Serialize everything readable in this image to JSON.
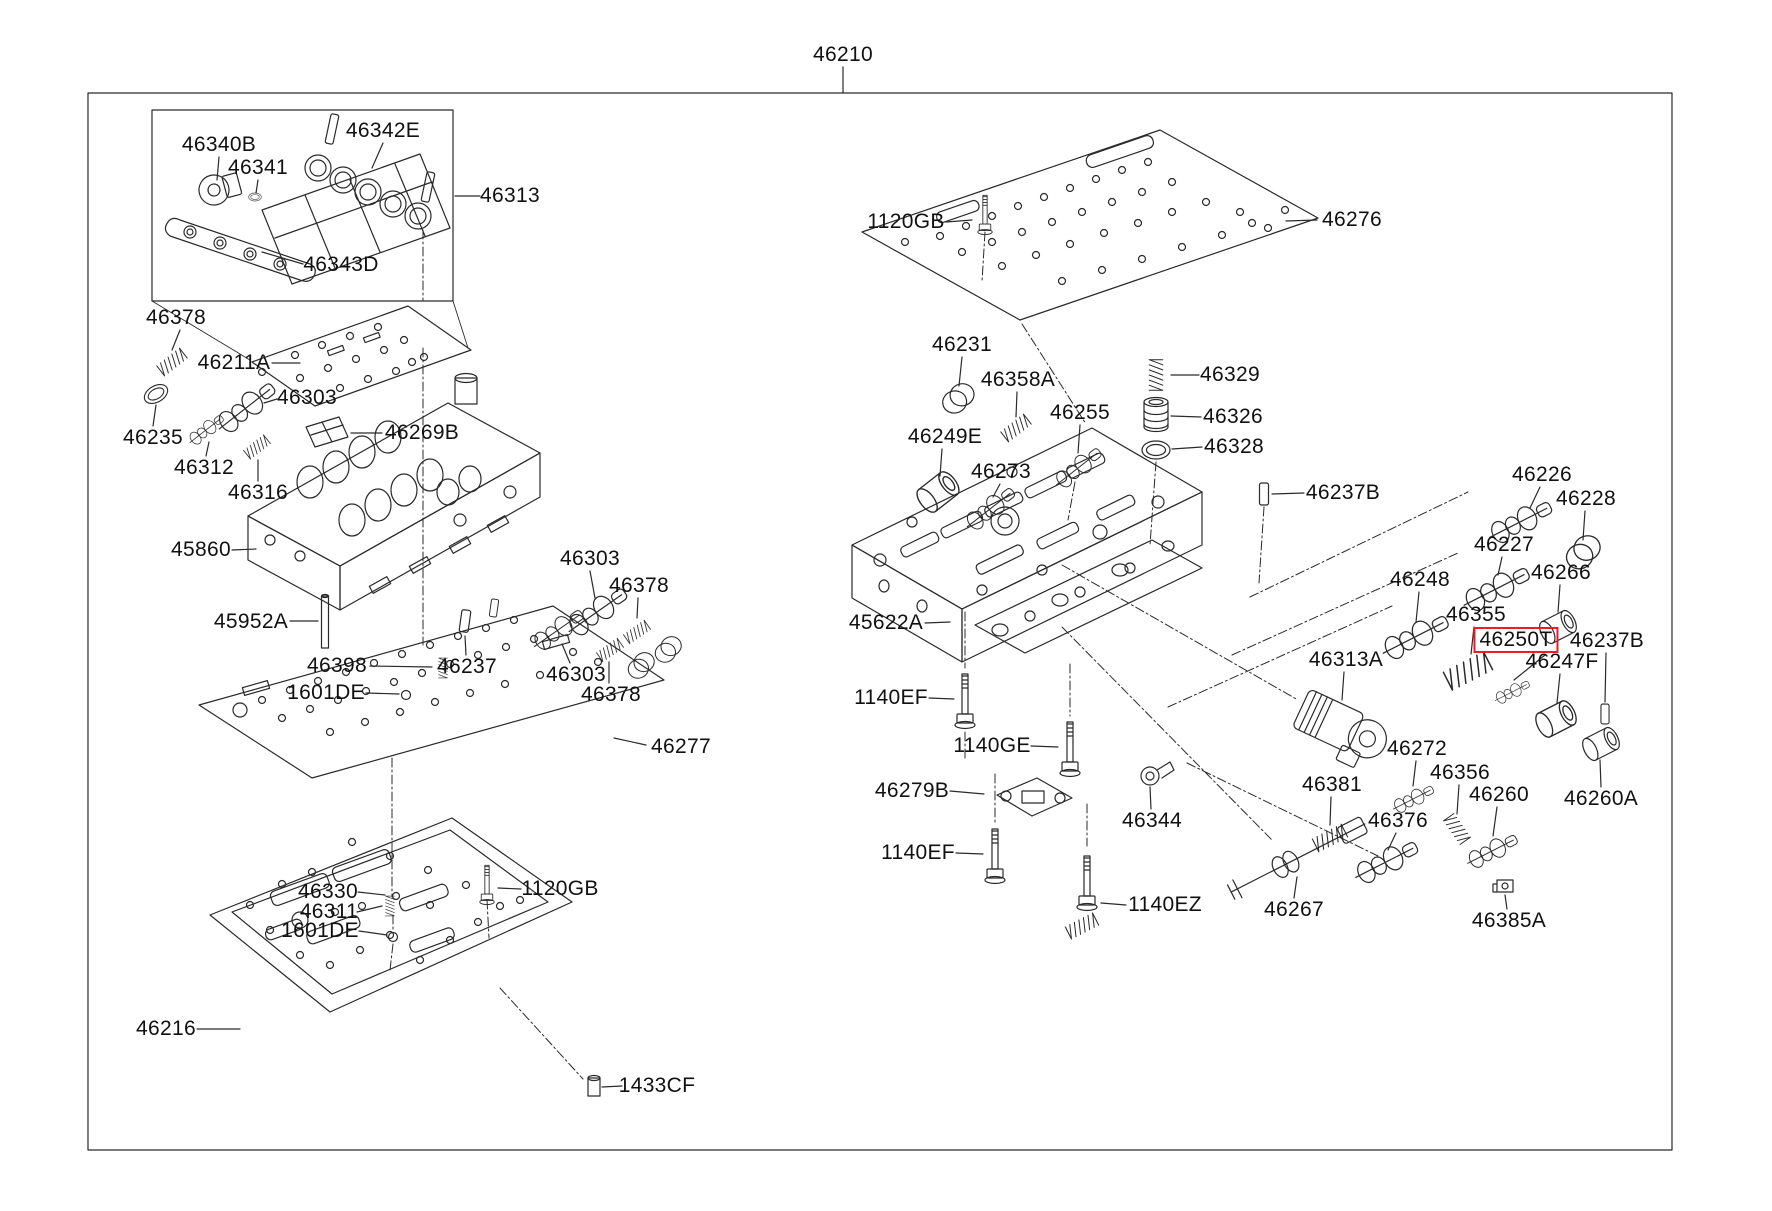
{
  "diagram": {
    "assembly_label": "46210",
    "highlight_color": "#ed1c24",
    "line_color": "#2a2a2a",
    "background": "#ffffff",
    "labels": [
      {
        "id": "46210",
        "t": "46210",
        "x": 843,
        "y": 55,
        "l": [
          843,
          67,
          843,
          93
        ]
      },
      {
        "id": "46340B",
        "t": "46340B",
        "x": 219,
        "y": 145,
        "l": [
          219,
          157,
          217,
          180
        ]
      },
      {
        "id": "46341",
        "t": "46341",
        "x": 258,
        "y": 168,
        "l": [
          258,
          180,
          256,
          193
        ]
      },
      {
        "id": "46342E",
        "t": "46342E",
        "x": 383,
        "y": 131,
        "l": [
          383,
          143,
          372,
          168
        ]
      },
      {
        "id": "46313",
        "t": "46313",
        "x": 510,
        "y": 196,
        "l": [
          480,
          196,
          455,
          196
        ]
      },
      {
        "id": "46343D",
        "t": "46343D",
        "x": 341,
        "y": 265,
        "l": [
          303,
          264,
          262,
          252
        ]
      },
      {
        "id": "46378a",
        "t": "46378",
        "x": 176,
        "y": 318,
        "l": [
          180,
          330,
          172,
          350
        ]
      },
      {
        "id": "46211A",
        "t": "46211A",
        "x": 234,
        "y": 363,
        "l": [
          272,
          363,
          300,
          363
        ]
      },
      {
        "id": "46303a",
        "t": "46303",
        "x": 307,
        "y": 398,
        "l": [
          277,
          399,
          264,
          403
        ]
      },
      {
        "id": "46235",
        "t": "46235",
        "x": 153,
        "y": 438,
        "l": [
          153,
          426,
          156,
          405
        ]
      },
      {
        "id": "46269B",
        "t": "46269B",
        "x": 422,
        "y": 433,
        "l": [
          382,
          433,
          351,
          433
        ]
      },
      {
        "id": "46312",
        "t": "46312",
        "x": 204,
        "y": 468,
        "l": [
          206,
          456,
          209,
          442
        ]
      },
      {
        "id": "46316",
        "t": "46316",
        "x": 258,
        "y": 493,
        "l": [
          258,
          481,
          258,
          460
        ]
      },
      {
        "id": "45860",
        "t": "45860",
        "x": 201,
        "y": 550,
        "l": [
          232,
          550,
          256,
          549
        ]
      },
      {
        "id": "45952A",
        "t": "45952A",
        "x": 251,
        "y": 622,
        "l": [
          290,
          621,
          318,
          621
        ]
      },
      {
        "id": "46398",
        "t": "46398",
        "x": 337,
        "y": 666,
        "l": [
          370,
          666,
          432,
          667
        ]
      },
      {
        "id": "46237a",
        "t": "46237",
        "x": 467,
        "y": 667,
        "l": [
          466,
          655,
          465,
          636
        ]
      },
      {
        "id": "46303b",
        "t": "46303",
        "x": 590,
        "y": 559,
        "l": [
          590,
          571,
          595,
          598
        ]
      },
      {
        "id": "46378b",
        "t": "46378",
        "x": 639,
        "y": 586,
        "l": [
          638,
          598,
          637,
          618
        ]
      },
      {
        "id": "46303c",
        "t": "46303",
        "x": 576,
        "y": 675,
        "l": [
          570,
          663,
          562,
          644
        ]
      },
      {
        "id": "46378c",
        "t": "46378",
        "x": 611,
        "y": 695,
        "l": [
          609,
          683,
          609,
          662
        ]
      },
      {
        "id": "1601DEa",
        "t": "1601DE",
        "x": 326,
        "y": 693,
        "l": [
          366,
          693,
          399,
          694
        ]
      },
      {
        "id": "46277",
        "t": "46277",
        "x": 681,
        "y": 747,
        "l": [
          646,
          745,
          614,
          738
        ]
      },
      {
        "id": "46330",
        "t": "46330",
        "x": 328,
        "y": 892,
        "l": [
          358,
          892,
          385,
          895
        ]
      },
      {
        "id": "46311",
        "t": "46311",
        "x": 329,
        "y": 912,
        "l": [
          357,
          912,
          382,
          906
        ]
      },
      {
        "id": "1601DEb",
        "t": "1601DE",
        "x": 320,
        "y": 931,
        "l": [
          359,
          931,
          387,
          935
        ]
      },
      {
        "id": "1120GBa",
        "t": "1120GB",
        "x": 560,
        "y": 889,
        "l": [
          521,
          889,
          498,
          888
        ]
      },
      {
        "id": "46216",
        "t": "46216",
        "x": 166,
        "y": 1029,
        "l": [
          197,
          1029,
          240,
          1029
        ]
      },
      {
        "id": "1433CF",
        "t": "1433CF",
        "x": 657,
        "y": 1086,
        "l": [
          622,
          1086,
          602,
          1087
        ]
      },
      {
        "id": "1120GBb",
        "t": "1120GB",
        "x": 906,
        "y": 222,
        "l": [
          946,
          222,
          972,
          220
        ]
      },
      {
        "id": "46276",
        "t": "46276",
        "x": 1352,
        "y": 220,
        "l": [
          1317,
          220,
          1286,
          221
        ]
      },
      {
        "id": "46231",
        "t": "46231",
        "x": 962,
        "y": 345,
        "l": [
          962,
          357,
          959,
          386
        ]
      },
      {
        "id": "46358A",
        "t": "46358A",
        "x": 1018,
        "y": 380,
        "l": [
          1017,
          392,
          1016,
          417
        ]
      },
      {
        "id": "46255",
        "t": "46255",
        "x": 1080,
        "y": 413,
        "l": [
          1080,
          425,
          1078,
          453
        ]
      },
      {
        "id": "46249E",
        "t": "46249E",
        "x": 945,
        "y": 437,
        "l": [
          942,
          449,
          940,
          476
        ]
      },
      {
        "id": "46273",
        "t": "46273",
        "x": 1001,
        "y": 472,
        "l": [
          1000,
          484,
          993,
          497
        ]
      },
      {
        "id": "46329",
        "t": "46329",
        "x": 1230,
        "y": 375,
        "l": [
          1199,
          375,
          1171,
          375
        ]
      },
      {
        "id": "46326",
        "t": "46326",
        "x": 1233,
        "y": 417,
        "l": [
          1201,
          417,
          1171,
          416
        ]
      },
      {
        "id": "46328",
        "t": "46328",
        "x": 1234,
        "y": 447,
        "l": [
          1202,
          447,
          1172,
          449
        ]
      },
      {
        "id": "46237Ba",
        "t": "46237B",
        "x": 1343,
        "y": 493,
        "l": [
          1304,
          493,
          1272,
          494
        ]
      },
      {
        "id": "46226",
        "t": "46226",
        "x": 1542,
        "y": 475,
        "l": [
          1540,
          487,
          1530,
          508
        ]
      },
      {
        "id": "46228",
        "t": "46228",
        "x": 1586,
        "y": 499,
        "l": [
          1585,
          511,
          1583,
          540
        ]
      },
      {
        "id": "46227",
        "t": "46227",
        "x": 1504,
        "y": 545,
        "l": [
          1502,
          557,
          1498,
          575
        ]
      },
      {
        "id": "46248",
        "t": "46248",
        "x": 1420,
        "y": 580,
        "l": [
          1419,
          592,
          1416,
          622
        ]
      },
      {
        "id": "46266",
        "t": "46266",
        "x": 1561,
        "y": 573,
        "l": [
          1560,
          585,
          1558,
          612
        ]
      },
      {
        "id": "46355",
        "t": "46355",
        "x": 1476,
        "y": 615,
        "l": [
          1474,
          627,
          1471,
          654
        ]
      },
      {
        "id": "46250T",
        "t": "46250T",
        "x": 1516,
        "y": 640,
        "hl": true,
        "l": [
          1545,
          655,
          1514,
          680
        ]
      },
      {
        "id": "46237Bb",
        "t": "46237B",
        "x": 1607,
        "y": 641,
        "l": [
          1606,
          653,
          1605,
          702
        ]
      },
      {
        "id": "46247F",
        "t": "46247F",
        "x": 1562,
        "y": 662,
        "l": [
          1560,
          674,
          1557,
          703
        ]
      },
      {
        "id": "46313A",
        "t": "46313A",
        "x": 1346,
        "y": 660,
        "l": [
          1344,
          672,
          1342,
          700
        ]
      },
      {
        "id": "46272",
        "t": "46272",
        "x": 1417,
        "y": 749,
        "l": [
          1416,
          761,
          1413,
          786
        ]
      },
      {
        "id": "46356",
        "t": "46356",
        "x": 1460,
        "y": 773,
        "l": [
          1459,
          785,
          1457,
          814
        ]
      },
      {
        "id": "46260",
        "t": "46260",
        "x": 1499,
        "y": 795,
        "l": [
          1497,
          807,
          1493,
          836
        ]
      },
      {
        "id": "46260A",
        "t": "46260A",
        "x": 1601,
        "y": 799,
        "l": [
          1601,
          787,
          1600,
          760
        ]
      },
      {
        "id": "46381",
        "t": "46381",
        "x": 1332,
        "y": 785,
        "l": [
          1331,
          797,
          1330,
          825
        ]
      },
      {
        "id": "46376",
        "t": "46376",
        "x": 1398,
        "y": 821,
        "l": [
          1396,
          833,
          1388,
          850
        ]
      },
      {
        "id": "46385A",
        "t": "46385A",
        "x": 1509,
        "y": 921,
        "l": [
          1507,
          909,
          1505,
          895
        ]
      },
      {
        "id": "46344",
        "t": "46344",
        "x": 1152,
        "y": 821,
        "l": [
          1151,
          809,
          1150,
          787
        ]
      },
      {
        "id": "1140EZ",
        "t": "1140EZ",
        "x": 1165,
        "y": 905,
        "l": [
          1126,
          905,
          1101,
          903
        ]
      },
      {
        "id": "46267",
        "t": "46267",
        "x": 1294,
        "y": 910,
        "l": [
          1294,
          898,
          1297,
          877
        ]
      },
      {
        "id": "45622A",
        "t": "45622A",
        "x": 886,
        "y": 623,
        "l": [
          925,
          623,
          950,
          622
        ]
      },
      {
        "id": "1140EFa",
        "t": "1140EF",
        "x": 891,
        "y": 698,
        "l": [
          929,
          698,
          954,
          699
        ]
      },
      {
        "id": "1140GE",
        "t": "1140GE",
        "x": 992,
        "y": 746,
        "l": [
          1031,
          746,
          1058,
          747
        ]
      },
      {
        "id": "46279B",
        "t": "46279B",
        "x": 912,
        "y": 791,
        "l": [
          950,
          791,
          984,
          794
        ]
      },
      {
        "id": "1140EFb",
        "t": "1140EF",
        "x": 918,
        "y": 853,
        "l": [
          956,
          853,
          983,
          854
        ]
      }
    ],
    "parts": [
      {
        "g": "solenoid",
        "x": 214,
        "y": 190,
        "r": -15,
        "s": 1
      },
      {
        "g": "oring",
        "x": 255,
        "y": 197,
        "r": 0,
        "s": 0.45
      },
      {
        "g": "coil",
        "x": 172,
        "y": 362,
        "r": -38,
        "s": 0.8
      },
      {
        "g": "oring",
        "x": 156,
        "y": 394,
        "r": -30,
        "s": 0.9
      },
      {
        "g": "spool",
        "x": 246,
        "y": 408,
        "r": -38,
        "s": 1
      },
      {
        "g": "spool",
        "x": 206,
        "y": 430,
        "r": -38,
        "s": 0.6
      },
      {
        "g": "filter",
        "x": 327,
        "y": 433,
        "r": 0,
        "s": 1
      },
      {
        "g": "coil",
        "x": 257,
        "y": 447,
        "r": -38,
        "s": 0.7
      },
      {
        "g": "pin",
        "x": 325,
        "y": 622,
        "r": 0,
        "s": 1
      },
      {
        "g": "coil",
        "x": 443,
        "y": 668,
        "r": 90,
        "s": 0.55
      },
      {
        "g": "wedge",
        "x": 465,
        "y": 621,
        "r": 8,
        "s": 1
      },
      {
        "g": "wedge",
        "x": 494,
        "y": 608,
        "r": 8,
        "s": 0.8
      },
      {
        "g": "spool",
        "x": 597,
        "y": 612,
        "r": -35,
        "s": 1
      },
      {
        "g": "coil",
        "x": 637,
        "y": 632,
        "r": -35,
        "s": 0.7
      },
      {
        "g": "spool",
        "x": 558,
        "y": 630,
        "r": -35,
        "s": 0.85
      },
      {
        "g": "coil",
        "x": 610,
        "y": 650,
        "r": -35,
        "s": 0.7
      },
      {
        "g": "plug",
        "x": 641,
        "y": 666,
        "r": -20,
        "s": 0.85
      },
      {
        "g": "plug",
        "x": 668,
        "y": 650,
        "r": -20,
        "s": 0.85
      },
      {
        "g": "dot",
        "x": 406,
        "y": 695,
        "r": 0,
        "s": 1
      },
      {
        "g": "coil",
        "x": 390,
        "y": 906,
        "r": 90,
        "s": 0.55
      },
      {
        "g": "dot",
        "x": 393,
        "y": 937,
        "r": 0,
        "s": 1
      },
      {
        "g": "bolt",
        "x": 487,
        "y": 884,
        "r": 0,
        "s": 0.72
      },
      {
        "g": "cyl",
        "x": 594,
        "y": 1087,
        "r": 0,
        "s": 1
      },
      {
        "g": "bolt",
        "x": 985,
        "y": 214,
        "r": 0,
        "s": 0.72
      },
      {
        "g": "plug",
        "x": 958,
        "y": 399,
        "r": -15,
        "s": 1
      },
      {
        "g": "coil",
        "x": 1016,
        "y": 428,
        "r": -38,
        "s": 0.8
      },
      {
        "g": "spool",
        "x": 1078,
        "y": 468,
        "r": -38,
        "s": 0.8
      },
      {
        "g": "sleeve",
        "x": 938,
        "y": 492,
        "r": -38,
        "s": 1.15
      },
      {
        "g": "spool",
        "x": 990,
        "y": 509,
        "r": -38,
        "s": 0.85
      },
      {
        "g": "coil",
        "x": 1156,
        "y": 375,
        "r": 90,
        "s": 0.85
      },
      {
        "g": "accum",
        "x": 1156,
        "y": 415,
        "r": 0,
        "s": 1
      },
      {
        "g": "oring",
        "x": 1156,
        "y": 450,
        "r": 0,
        "s": 1
      },
      {
        "g": "wedge",
        "x": 1264,
        "y": 494,
        "r": 0,
        "s": 1
      },
      {
        "g": "spool",
        "x": 1520,
        "y": 522,
        "r": -27,
        "s": 1
      },
      {
        "g": "plug",
        "x": 1583,
        "y": 553,
        "r": -20,
        "s": 1.1
      },
      {
        "g": "spool",
        "x": 1496,
        "y": 589,
        "r": -27,
        "s": 1.05
      },
      {
        "g": "spool",
        "x": 1415,
        "y": 637,
        "r": -27,
        "s": 1.05
      },
      {
        "g": "sleeve",
        "x": 1558,
        "y": 627,
        "r": -27,
        "s": 1
      },
      {
        "g": "coil",
        "x": 1468,
        "y": 671,
        "r": -27,
        "s": 1.25
      },
      {
        "g": "spool",
        "x": 1512,
        "y": 692,
        "r": -27,
        "s": 0.55
      },
      {
        "g": "wedge",
        "x": 1605,
        "y": 714,
        "r": 0,
        "s": 0.9
      },
      {
        "g": "sleeve",
        "x": 1556,
        "y": 719,
        "r": -27,
        "s": 1.1
      },
      {
        "g": "solenoid-lg",
        "x": 1342,
        "y": 727,
        "r": 25,
        "s": 1
      },
      {
        "g": "spool",
        "x": 1413,
        "y": 799,
        "r": -27,
        "s": 0.65
      },
      {
        "g": "coil",
        "x": 1457,
        "y": 829,
        "r": 55,
        "s": 0.8
      },
      {
        "g": "spool",
        "x": 1492,
        "y": 851,
        "r": -27,
        "s": 0.8
      },
      {
        "g": "sleeve",
        "x": 1601,
        "y": 744,
        "r": -27,
        "s": 1
      },
      {
        "g": "coil",
        "x": 1330,
        "y": 838,
        "r": -27,
        "s": 0.9
      },
      {
        "g": "spool",
        "x": 1386,
        "y": 862,
        "r": -27,
        "s": 1
      },
      {
        "g": "clip",
        "x": 1505,
        "y": 886,
        "r": 0,
        "s": 1
      },
      {
        "g": "clamp",
        "x": 1150,
        "y": 776,
        "r": 0,
        "s": 1
      },
      {
        "g": "shaft",
        "x": 1298,
        "y": 858,
        "r": -27,
        "s": 1
      },
      {
        "g": "coil",
        "x": 1082,
        "y": 926,
        "r": -27,
        "s": 0.85
      },
      {
        "g": "bracket",
        "x": 1032,
        "y": 800,
        "r": 0,
        "s": 1
      },
      {
        "g": "bolt",
        "x": 965,
        "y": 700,
        "r": 0,
        "s": 1
      },
      {
        "g": "bolt",
        "x": 1070,
        "y": 748,
        "r": 0,
        "s": 1
      },
      {
        "g": "bolt",
        "x": 995,
        "y": 855,
        "r": 0,
        "s": 1
      },
      {
        "g": "bolt",
        "x": 1087,
        "y": 882,
        "r": 0,
        "s": 1
      }
    ]
  }
}
